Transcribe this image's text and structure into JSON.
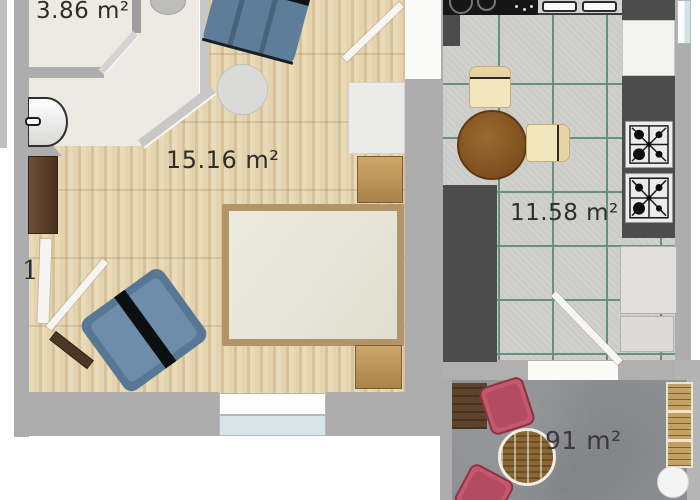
{
  "rooms": {
    "bathroom": {
      "area_label": "3.86 m²",
      "furniture": [
        "washbasin",
        "toilet",
        "door"
      ]
    },
    "bedroom": {
      "area_label": "15.16 m²",
      "door_label": "1",
      "furniture": [
        "armchair",
        "side-table",
        "wardrobe",
        "nightstand",
        "double-bed",
        "nightstand",
        "armchair",
        "cabinet",
        "bench",
        "window",
        "entry-door"
      ]
    },
    "kitchen": {
      "area_label": "11.58 m²",
      "furniture": [
        "cooktop",
        "double-sink",
        "counter",
        "round-dining-table",
        "chair",
        "chair",
        "gas-hob",
        "gas-hob",
        "appliance",
        "fridge",
        "door"
      ]
    },
    "balcony": {
      "area_label": "91 m²",
      "furniture": [
        "doormat",
        "armchair",
        "armchair",
        "rattan-table",
        "bench",
        "stool"
      ]
    }
  },
  "colors": {
    "wall": "#adadad",
    "wood_floor": "#e3d1ad",
    "bathroom_floor": "#edeae3",
    "kitchen_tile": "#cbcbc9",
    "tile_grout": "#68907f",
    "balcony_concrete": "#8e9094",
    "counter_dark": "#4c4c4c",
    "bed_frame": "#b29468",
    "mattress": "#eae8dc",
    "wood_furniture": "#c9a265",
    "blue_chair": "#5d7d99",
    "pink_chair": "#c5586d",
    "cream_chair": "#f2e6bf",
    "dining_table": "#8a5a28",
    "window_glass": "#d7e5e9",
    "label_text": "#2d2d2d"
  }
}
